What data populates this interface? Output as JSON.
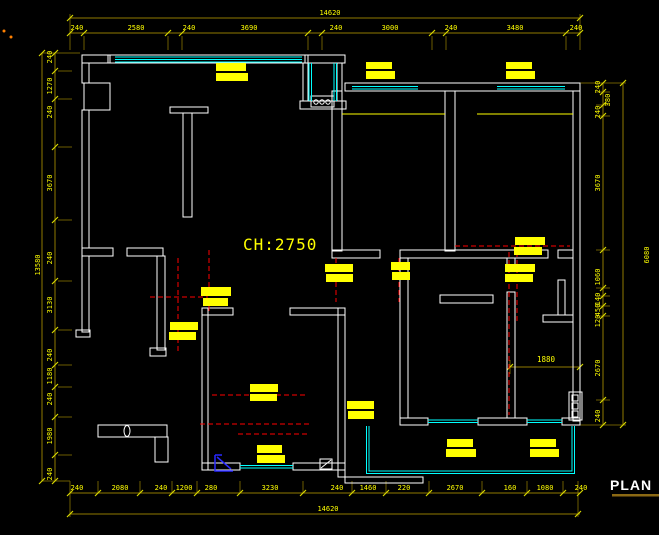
{
  "drawing": {
    "plan_label": "PLAN",
    "ceiling_note": "CH:2750",
    "interior_dim": "1880"
  },
  "colors": {
    "background": "#000000",
    "walls": "#ffffff",
    "windows": "#00ffff",
    "risers": "#ff0000",
    "highlights": "#ffff00",
    "dim_lines": "#8f7a00",
    "dim_ticks": "#d8d800",
    "dim_text": "#ffff00",
    "detail_blue": "#2929ff",
    "underline": "#8b6914",
    "accent_dots": "#ff8000"
  },
  "dims": {
    "top_total": "14620",
    "bottom_total": "14620",
    "left_total": "13580",
    "right_total": "6080",
    "top": [
      "240",
      "2580",
      "240",
      "3690",
      "240",
      "3000",
      "240",
      "3480",
      "240"
    ],
    "bottom": [
      "240",
      "2080",
      "240",
      "1200",
      "280",
      "3230",
      "240",
      "1460",
      "220",
      "2670",
      "160",
      "1080",
      "240"
    ],
    "left": [
      "240",
      "1270",
      "240",
      "3670",
      "240",
      "3130",
      "240",
      "1180",
      "240",
      "1980",
      "240"
    ],
    "right": [
      "240",
      "380",
      "240",
      "3670",
      "1060",
      "140",
      "450",
      "120",
      "2670",
      "240"
    ]
  }
}
